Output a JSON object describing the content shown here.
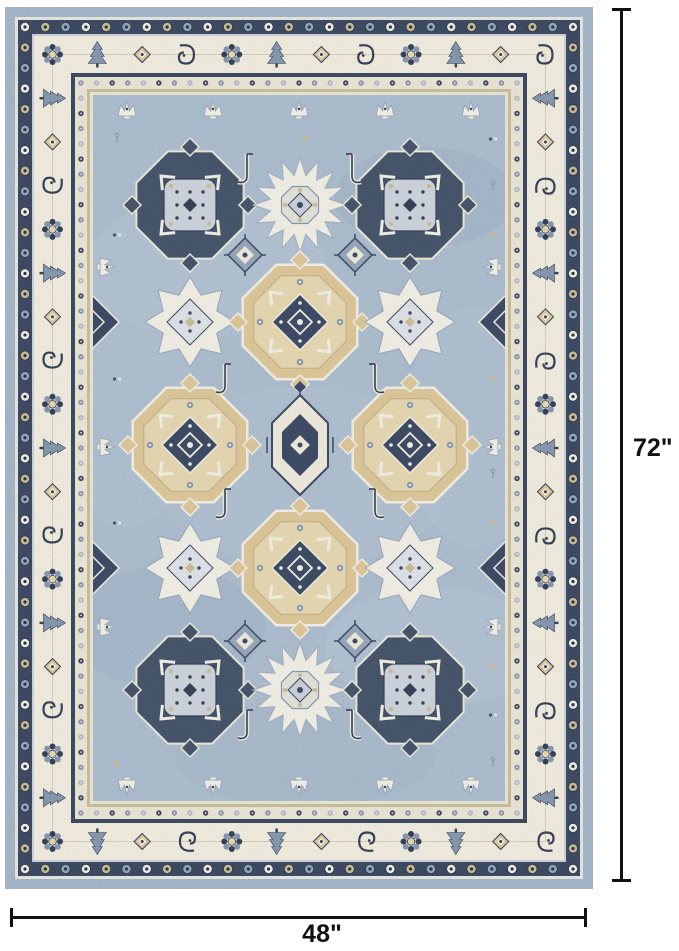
{
  "page": {
    "background": "#ffffff",
    "description": "Product photo of a blue and ivory Persian Kazak style medallion area rug with size annotations"
  },
  "annotations": {
    "height_label": "72\"",
    "width_label": "48\"",
    "line_color": "#111111"
  },
  "rug": {
    "style": "persian-kazak-medallion",
    "palette": {
      "edge_blue": "#9fb2c6",
      "guard_white": "#e7e7e2",
      "navy": "#2b3a54",
      "separator_blue": "#c7cfda",
      "border_cream": "#f3eedf",
      "inner_cream": "#ece7d5",
      "tan_guard": "#c9bb97",
      "field_blue": "#a7bacd",
      "motif_white": "#f4f1e6",
      "motif_tan": "#dcc592",
      "motif_tan_light": "#e7d7ad",
      "motif_tan_dark": "#c9b98c",
      "steel_blue": "#7d91a9",
      "slate_blue": "#8fa0b5",
      "ink_navy": "#22304a",
      "medallion_navy": "#2c3b57"
    },
    "border_bands": [
      "outer-blue-edge",
      "white-guard",
      "navy-rosette-band",
      "ivory-main-border",
      "navy-guard",
      "ivory-rosette-band",
      "tan-guard",
      "field"
    ],
    "medallion_layout": [
      [
        "dark-octagon",
        "white-snowflake",
        "dark-octagon"
      ],
      [
        "white-diamond",
        "tan-octagon",
        "white-diamond"
      ],
      [
        "tan-octagon",
        "center-hexagon",
        "tan-octagon"
      ],
      [
        "white-diamond",
        "tan-octagon",
        "white-diamond"
      ],
      [
        "dark-octagon",
        "white-snowflake",
        "dark-octagon"
      ]
    ]
  }
}
